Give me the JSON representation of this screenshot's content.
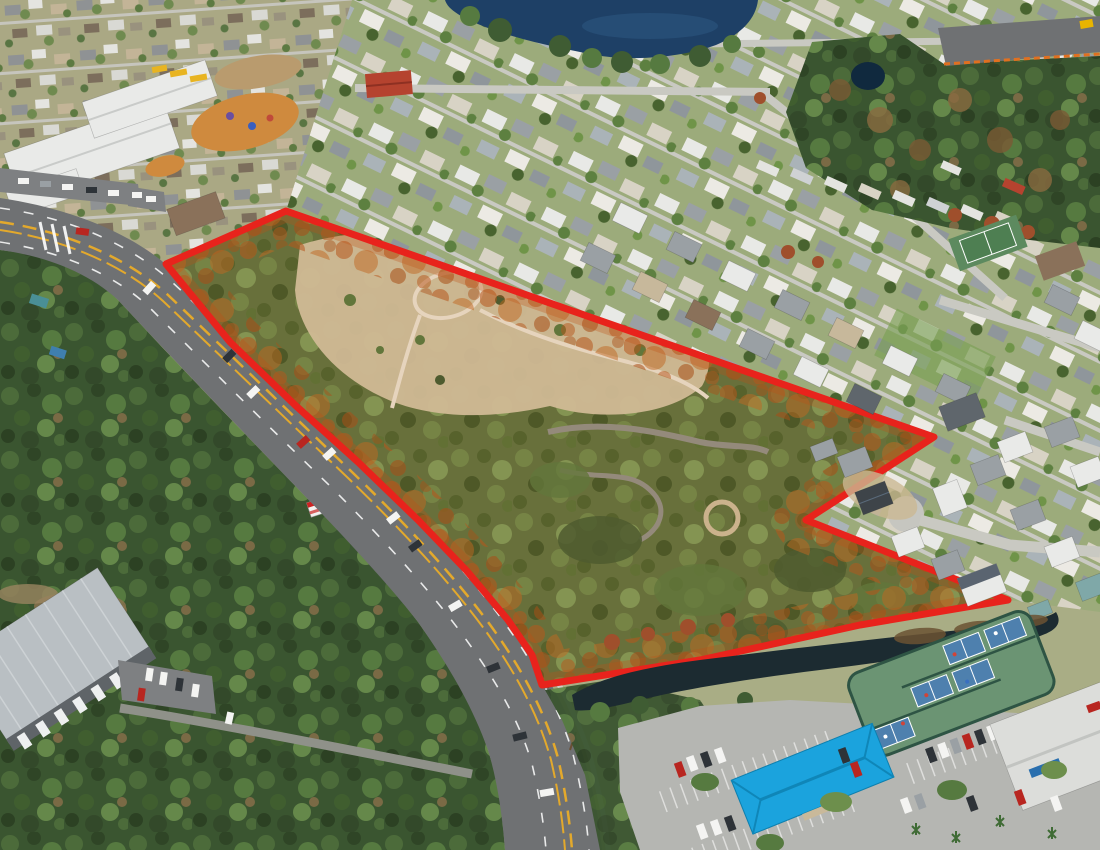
{
  "meta": {
    "image_kind": "aerial-drone-photograph",
    "subject": "wooded vacant land parcel outlined in red beside a divided highway, surrounded by residential neighborhoods",
    "width_px": 1100,
    "height_px": 850
  },
  "parcel": {
    "name": "highlighted-land-parcel",
    "boundary_points": "286,211 934,437 806,520 1008,600 860,625 700,660 542,685 532,655 508,620 466,570 418,520 358,462 295,405 230,342 166,264",
    "outline_color": "#e8231c",
    "interior_tint": "#b85418",
    "interior_features": [
      "sandy clearing",
      "winding dirt trail loop",
      "abandoned paved lanes",
      "pine trees"
    ]
  },
  "palette": {
    "outline-red": "#e8231c",
    "glow-rust": "#b85418",
    "water-lake": "#1e4066",
    "water-pond": "#1c2b31",
    "algae": "#6b5233",
    "road": "#6f7173",
    "median-yellow": "#e3a92c",
    "sidewalk": "#cfcec8",
    "lot": "#b5b6b2",
    "lot-dark": "#7e8082",
    "grass": "#a9ad85",
    "lawn": "#9cab7b",
    "sand": "#d3c7a7",
    "dirt-orange": "#cf8a3e",
    "roof-white": "#e9eae8",
    "roof-gray": "#9aa0a4",
    "roof-slate": "#5f666c",
    "roof-tan": "#c7b89b",
    "roof-brown": "#8a715a",
    "roof-red": "#b5432f",
    "roof-blue": "#1ba3dd",
    "roof-metal": "#b9bfc3",
    "court-green": "#6b9473",
    "court-blue": "#4e80ae",
    "fence-green": "#2e5444",
    "tree-dark": "#3f5c33",
    "tree-mid": "#567a40",
    "tree-light": "#6d8f4c",
    "tree-rust": "#9f4f2c",
    "trail": "#ece5d4"
  },
  "features": [
    "school-campus-with-white-roofs",
    "playground-orange-sand",
    "school-buses",
    "old-neighborhood-top-left",
    "new-beach-community-top-center",
    "lake-top-center",
    "small-pond-in-woods",
    "woodland-top-right",
    "highway-under-construction-top-right",
    "mobile-home-row",
    "tennis-court",
    "divided-four-lane-highway",
    "roadside-billboard",
    "utility-warehouse-bottom-left",
    "drainage-pond-bottom",
    "pickleball-court-complex",
    "community-building-bright-blue-roof",
    "large-parking-lot-bottom-right",
    "church-building-bottom-right-corner",
    "cul-de-sac-with-new-houses"
  ]
}
